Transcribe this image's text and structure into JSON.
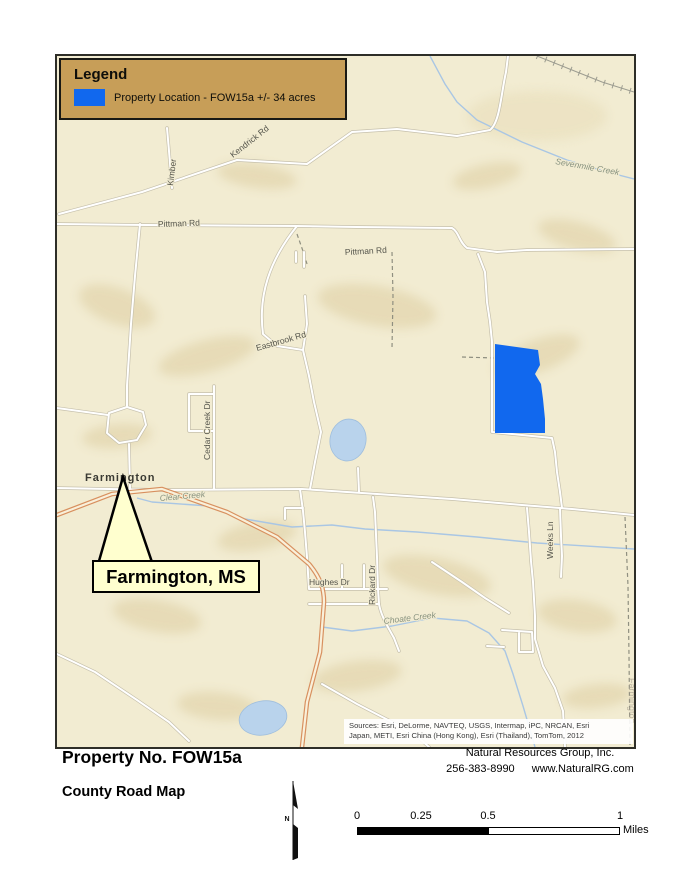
{
  "legend": {
    "title": "Legend",
    "item": "Property Location - FOW15a +/- 34 acres"
  },
  "map": {
    "road_labels": [
      "Kimber",
      "Kendrick Rd",
      "Pittman Rd",
      "Pittman Rd",
      "Eastbrook Rd",
      "Cedar Creek Dr",
      "Hughes Dr",
      "Rickard Dr",
      "Weeks Ln"
    ],
    "creek_labels": [
      "Sevenmile Creek",
      "Clear Creek",
      "Choate Creek"
    ],
    "town_label": "Farmington",
    "edge_label": "Farmington",
    "callout_text": "Farmington, MS",
    "sources_line1": "Sources: Esri, DeLorme, NAVTEQ, USGS, Intermap, iPC, NRCAN, Esri",
    "sources_line2": "Japan, METI, Esri China (Hong Kong), Esri (Thailand), TomTom, 2012"
  },
  "footer": {
    "property_no": "Property No. FOW15a",
    "map_type": "County Road Map",
    "company": "Natural Resources Group, Inc.",
    "phone": "256-383-8990",
    "website": "www.NaturalRG.com",
    "north_label": "N",
    "scalebar": {
      "tick0": "0",
      "tick1": "0.25",
      "tick2": "0.5",
      "tick3": "1",
      "unit": "Miles"
    }
  },
  "colors": {
    "property_blue": "#1168ee",
    "legend_tan": "#c79e58",
    "callout_yellow": "#ffffcf",
    "map_cream": "#f2ecd2"
  }
}
